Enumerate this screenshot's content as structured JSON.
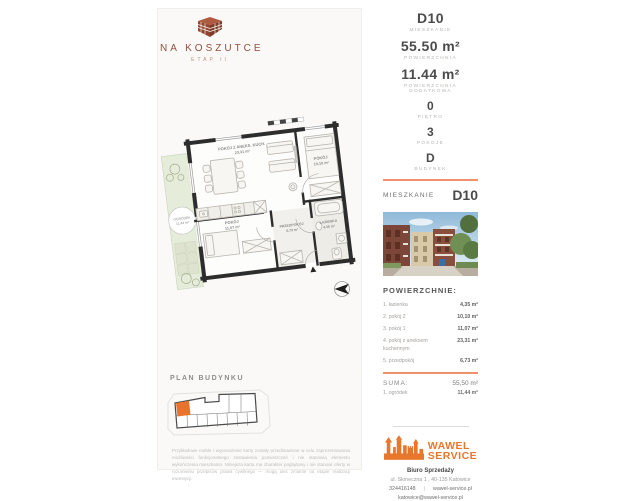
{
  "brand": {
    "name": "NA KOSZUTCE",
    "stage": "ETAP II"
  },
  "stats": {
    "items": [
      {
        "value": "D10",
        "label": "MIESZKANIE"
      },
      {
        "value": "55.50 m²",
        "label": "POWIERZCHNIA"
      },
      {
        "value": "11.44 m²",
        "label": "POWIERZCHNIA DODATKOWA"
      },
      {
        "value": "0",
        "label": "PIĘTRO"
      },
      {
        "value": "3",
        "label": "POKOJE"
      },
      {
        "value": "D",
        "label": "BUDYNEK"
      }
    ]
  },
  "apartment_bar": {
    "label": "MIESZKANIE",
    "value": "D10"
  },
  "areas": {
    "heading": "POWIERZCHNIE:",
    "rows": [
      {
        "label": "1. łazienka",
        "value": "4,35 m²"
      },
      {
        "label": "2. pokój 2",
        "value": "10,10 m²"
      },
      {
        "label": "3. pokój 1",
        "value": "11,07 m²"
      },
      {
        "label": "4. pokój z aneksem kuchennym",
        "value": "23,31 m²"
      },
      {
        "label": "5. przedpokój",
        "value": "6,73 m²"
      }
    ],
    "suma_label": "SUMA:",
    "suma_value": "55,50 m²",
    "garden_label": "1. ogródek",
    "garden_value": "11,44 m²"
  },
  "floorplan": {
    "rooms": {
      "living": {
        "name": "POKÓJ Z ANEKS. KUCH.",
        "area": "23,31 m²"
      },
      "bedroom": {
        "name": "POKÓJ",
        "area": "10,10 m²"
      },
      "room1": {
        "name": "POKÓJ",
        "area": "11,07 m²"
      },
      "hall": {
        "name": "PRZEDPOKÓJ",
        "area": "6,73 m²"
      },
      "bath": {
        "name": "ŁAZIENKA",
        "area": "4,35 m²"
      },
      "garden": {
        "name": "OGRÓDEK",
        "area": "11,44 m²"
      }
    }
  },
  "building_plan": {
    "title": "PLAN BUDYNKU"
  },
  "vendor": {
    "brand_top": "WAWEL",
    "brand_bottom": "SERVICE",
    "office": "Biuro Sprzedaży",
    "address": "ul. Słoneczna 1 , 40-135 Katowice",
    "phone": "324416148",
    "divider": "|",
    "website": "wawel-service.pl",
    "email": "katowice@wawel-service.pl"
  },
  "disclaimer": "Przykładowe meble i wyposażenie karty zostały przedstawione w celu zaprezentowania możliwości funkcjonalnego zestawienia pomieszczeń i nie stanowią elementu wykończenia mieszkania. Niniejsza karta ma charakter poglądowy i nie stanowi oferty w rozumieniu przepisów prawa cywilnego — mogą ulec zmianie na etapie realizacji inwestycji.",
  "colors": {
    "accent": "#f0916c",
    "vendor_orange": "#e8762b",
    "brick_logo": "#94503c",
    "unit_highlight": "#e8732e",
    "garden_green": "#e6ecda"
  }
}
